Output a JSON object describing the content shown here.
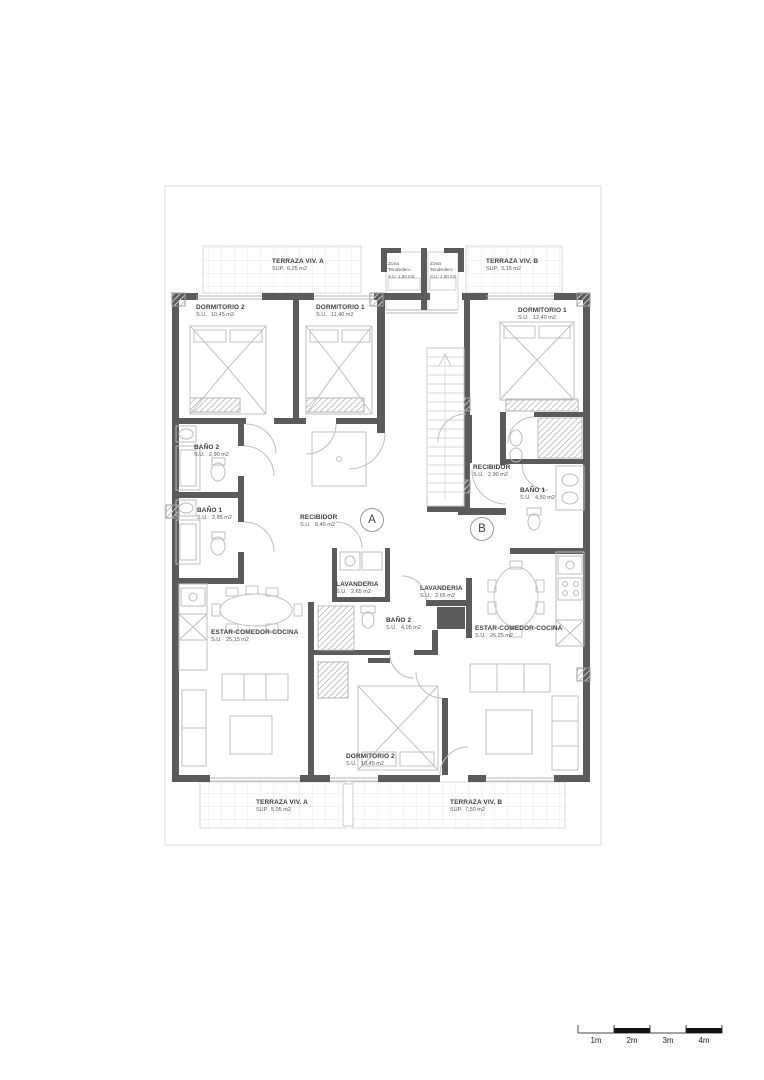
{
  "plan_labels": {
    "terraza_viv_a_top": {
      "name": "TERRAZA VIV. A",
      "prefix": "SUP.",
      "area": "6,25 m2"
    },
    "zona_tendedero_left": {
      "line1": "Zona",
      "line2": "Tendedero",
      "prefix": "S.U.",
      "area": "1,50 m2"
    },
    "zona_tendedero_right": {
      "line1": "Zona",
      "line2": "Tendedero",
      "prefix": "S.U.",
      "area": "1,50 m2"
    },
    "terraza_viv_b_top": {
      "name": "TERRAZA VIV. B",
      "prefix": "SUP.",
      "area": "3,15 m2"
    },
    "dormitorio_2_top": {
      "name": "DORMITORIO 2",
      "prefix": "S.U.",
      "area": "10,45 m2"
    },
    "dormitorio_1_a": {
      "name": "DORMITORIO 1",
      "prefix": "S.U.",
      "area": "11,40 m2"
    },
    "dormitorio_1_b": {
      "name": "DORMITORIO 1",
      "prefix": "S.U.",
      "area": "12,40 m2"
    },
    "bano_2_a": {
      "name": "BAÑO 2",
      "prefix": "S.U.",
      "area": "2,90 m2"
    },
    "bano_1_a": {
      "name": "BAÑO 1",
      "prefix": "S.U.",
      "area": "2,85 m2"
    },
    "recibidor_a": {
      "name": "RECIBIDOR",
      "prefix": "S.U.",
      "area": "8,40 m2"
    },
    "recibidor_b": {
      "name": "RECIBIDOR",
      "prefix": "S.U.",
      "area": "2,90 m2"
    },
    "bano_1_b": {
      "name": "BAÑO 1",
      "prefix": "S.U.",
      "area": "4,50 m2"
    },
    "lavanderia_a": {
      "name": "LAVANDERIA",
      "prefix": "S.U.",
      "area": "2,65 m2"
    },
    "lavanderia_b": {
      "name": "LAVANDERIA",
      "prefix": "S.U.",
      "area": "2,65 m2"
    },
    "bano_2_b": {
      "name": "BAÑO 2",
      "prefix": "S.U.",
      "area": "4,05 m2"
    },
    "estar_a": {
      "name": "ESTAR-COMEDOR-COCINA",
      "prefix": "S.U.",
      "area": "25,15 m2"
    },
    "estar_b": {
      "name": "ESTAR-COMEDOR-COCINA",
      "prefix": "S.U.",
      "area": "26,25 m2"
    },
    "dormitorio_2_bottom": {
      "name": "DORMITORIO 2",
      "prefix": "S.U.",
      "area": "10,45 m2"
    },
    "terraza_viv_a_bottom": {
      "name": "TERRAZA VIV. A",
      "prefix": "SUP.",
      "area": "5,05 m2"
    },
    "terraza_viv_b_bottom": {
      "name": "TERRAZA VIV. B",
      "prefix": "SUP.",
      "area": "7,50 m2"
    }
  },
  "unit_markers": {
    "a": "A",
    "b": "B"
  },
  "scale_bar": {
    "labels": [
      "1m",
      "2m",
      "3m",
      "4m"
    ]
  },
  "colors": {
    "wall": "#5b5b5b",
    "furniture": "#c2c2c2",
    "tile": "#e7e7e7",
    "faint": "#dedede"
  }
}
